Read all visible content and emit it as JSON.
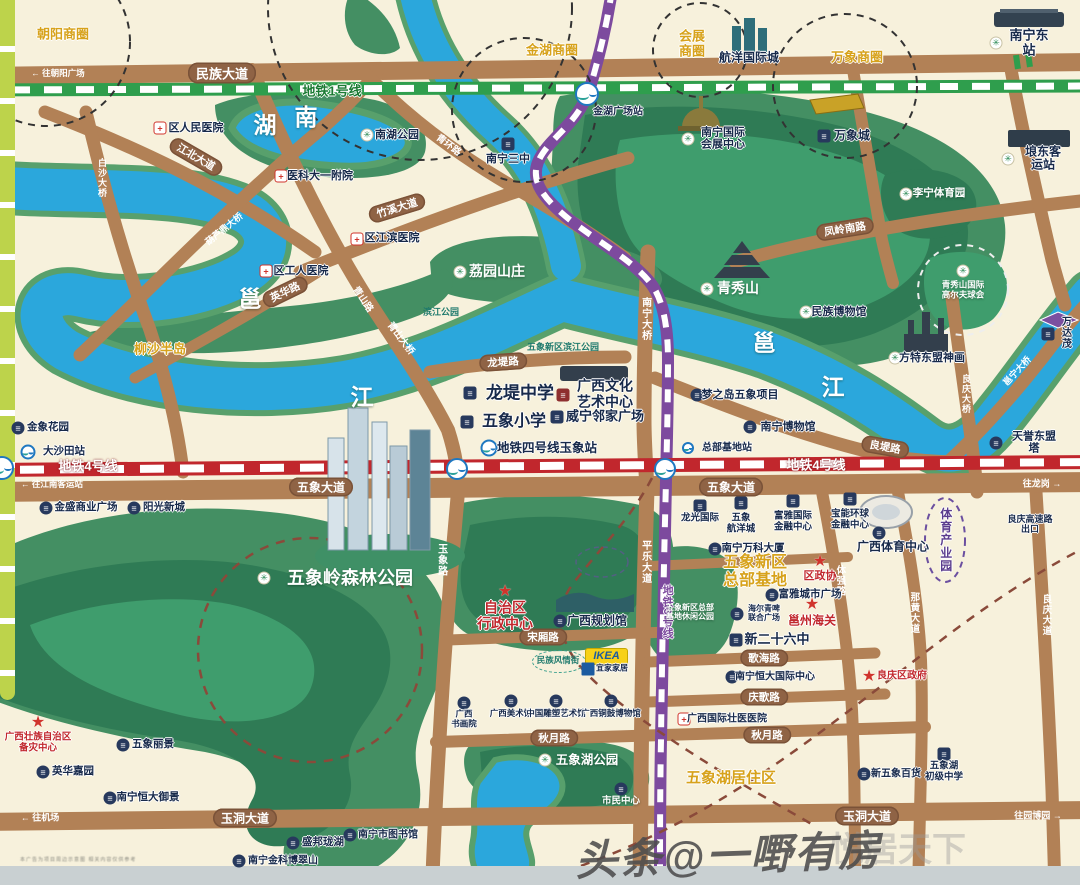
{
  "watermark": {
    "main": "头条@一嘢有房",
    "behind": "悦居天下"
  },
  "disclaimer": "本广告为项目周边示意图 相关内容仅供参考",
  "ikea_logo": "IKEA",
  "colors": {
    "water": "#2ba7dc",
    "park": "#448f63",
    "road": "#b28156",
    "metro1": "#2f9e4d",
    "metro3": "#7d4a9e",
    "metro4": "#c1272d",
    "gold": "#d7a21b",
    "lime": "#bdd34b"
  },
  "water_chars": [
    {
      "t": "湖",
      "x": 265,
      "y": 126
    },
    {
      "t": "南",
      "x": 306,
      "y": 118
    },
    {
      "t": "邕",
      "x": 250,
      "y": 300
    },
    {
      "t": "江",
      "x": 362,
      "y": 398
    },
    {
      "t": "邕",
      "x": 764,
      "y": 344
    },
    {
      "t": "江",
      "x": 833,
      "y": 388
    }
  ],
  "gold_labels": [
    {
      "t": "朝阳商圈",
      "x": 63,
      "y": 35,
      "fs": 13
    },
    {
      "t": "金湖商圈",
      "x": 552,
      "y": 51,
      "fs": 13
    },
    {
      "t": "会展\n商圈",
      "x": 692,
      "y": 44,
      "fs": 13
    },
    {
      "t": "万象商圈",
      "x": 857,
      "y": 58,
      "fs": 13
    },
    {
      "t": "柳沙半岛",
      "x": 160,
      "y": 350,
      "fs": 13
    },
    {
      "t": "五象新区\n总部基地",
      "x": 755,
      "y": 572,
      "fs": 16
    },
    {
      "t": "五象湖居住区",
      "x": 731,
      "y": 779,
      "fs": 15
    },
    {
      "t": "体育产业园",
      "x": 945,
      "y": 540,
      "fs": 12,
      "v": 1,
      "cl": "purple"
    }
  ],
  "road_pills": [
    {
      "t": "民族大道",
      "x": 222,
      "y": 73,
      "fs": 13
    },
    {
      "t": "江北大道",
      "x": 196,
      "y": 157,
      "r": 30
    },
    {
      "t": "竹溪大道",
      "x": 397,
      "y": 208,
      "r": -17
    },
    {
      "t": "英华路",
      "x": 285,
      "y": 292,
      "r": -26
    },
    {
      "t": "龙堤路",
      "x": 503,
      "y": 362,
      "r": -4
    },
    {
      "t": "良堤路",
      "x": 885,
      "y": 447,
      "r": 10
    },
    {
      "t": "凤岭南路",
      "x": 845,
      "y": 229,
      "r": -9
    },
    {
      "t": "五象大道",
      "x": 321,
      "y": 487,
      "fs": 12
    },
    {
      "t": "五象大道",
      "x": 731,
      "y": 487,
      "fs": 12
    },
    {
      "t": "玉洞大道",
      "x": 245,
      "y": 818,
      "fs": 12
    },
    {
      "t": "玉洞大道",
      "x": 867,
      "y": 816,
      "fs": 12
    },
    {
      "t": "宋厢路",
      "x": 543,
      "y": 637
    },
    {
      "t": "秋月路",
      "x": 554,
      "y": 738
    },
    {
      "t": "秋月路",
      "x": 767,
      "y": 735
    },
    {
      "t": "歌海路",
      "x": 764,
      "y": 658
    },
    {
      "t": "庆歌路",
      "x": 764,
      "y": 697
    }
  ],
  "road_names": [
    {
      "t": "白沙大桥",
      "x": 102,
      "y": 178,
      "v": 1,
      "fs": 9
    },
    {
      "t": "葫芦鼎大桥",
      "x": 224,
      "y": 229,
      "r": -39,
      "fs": 9
    },
    {
      "t": "青山路",
      "x": 362,
      "y": 300,
      "r": 56,
      "fs": 9.5
    },
    {
      "t": "青山大桥",
      "x": 400,
      "y": 339,
      "r": 53,
      "fs": 9.5
    },
    {
      "t": "青环路",
      "x": 448,
      "y": 146,
      "r": 37,
      "fs": 9.5
    },
    {
      "t": "南宁大桥",
      "x": 645,
      "y": 319,
      "v": 1,
      "fs": 10
    },
    {
      "t": "平乐大道",
      "x": 645,
      "y": 562,
      "v": 1,
      "fs": 10
    },
    {
      "t": "玉象路",
      "x": 441,
      "y": 560,
      "v": 1,
      "fs": 10
    },
    {
      "t": "良庆大桥",
      "x": 966,
      "y": 394,
      "v": 1,
      "fs": 9
    },
    {
      "t": "邕宁大桥",
      "x": 1017,
      "y": 371,
      "r": -47,
      "fs": 9
    },
    {
      "t": "体强路",
      "x": 839,
      "y": 581,
      "v": 1,
      "fs": 9.5
    },
    {
      "t": "那黄大道",
      "x": 913,
      "y": 613,
      "v": 1,
      "fs": 9.5
    },
    {
      "t": "良庆大道",
      "x": 1045,
      "y": 615,
      "v": 1,
      "fs": 9.5
    }
  ],
  "metro_labels": [
    {
      "t": "地铁1号线",
      "x": 332,
      "y": 92,
      "cl": "m1",
      "fs": 13
    },
    {
      "t": "地铁4号线",
      "x": 88,
      "y": 467,
      "cl": "m4",
      "fs": 13
    },
    {
      "t": "地铁4号线",
      "x": 816,
      "y": 466,
      "cl": "m4",
      "fs": 13
    },
    {
      "t": "地铁3号线",
      "x": 667,
      "y": 612,
      "cl": "m3",
      "v": 1,
      "fs": 11
    }
  ],
  "arrows": [
    {
      "t": "← 往朝阳广场",
      "x": 58,
      "y": 73,
      "fs": 8.5
    },
    {
      "t": "← 往江南客运站",
      "x": 52,
      "y": 484,
      "fs": 8.5
    },
    {
      "t": "← 往机场",
      "x": 40,
      "y": 817,
      "fs": 9
    },
    {
      "t": "往龙岗 →",
      "x": 1042,
      "y": 483,
      "fs": 9
    },
    {
      "t": "往园博园 →",
      "x": 1038,
      "y": 815,
      "fs": 9
    }
  ],
  "stations": [
    {
      "x": 587,
      "y": 94,
      "s": 24
    },
    {
      "x": 457,
      "y": 469,
      "s": 22
    },
    {
      "x": 665,
      "y": 469,
      "s": 22
    },
    {
      "x": 2,
      "y": 468,
      "s": 24
    },
    {
      "x": 28,
      "y": 452,
      "s": 15
    },
    {
      "x": 489,
      "y": 448,
      "s": 17
    },
    {
      "x": 688,
      "y": 448,
      "s": 12
    }
  ],
  "pois": [
    {
      "ic": "h",
      "ix": 160,
      "iy": 128,
      "t": "区人民医院",
      "tx": 196,
      "ty": 128,
      "fs": 11
    },
    {
      "ic": "h",
      "ix": 281,
      "iy": 176,
      "t": "医科大一附院",
      "tx": 320,
      "ty": 176,
      "fs": 11
    },
    {
      "ic": "h",
      "ix": 357,
      "iy": 239,
      "t": "区江滨医院",
      "tx": 392,
      "ty": 238,
      "fs": 11
    },
    {
      "ic": "h",
      "ix": 266,
      "iy": 271,
      "t": "区工人医院",
      "tx": 301,
      "ty": 271,
      "fs": 11
    },
    {
      "ic": "p",
      "ix": 367,
      "iy": 135,
      "t": "南湖公园",
      "tx": 397,
      "ty": 135,
      "fs": 11
    },
    {
      "ic": "b",
      "ix": 508,
      "iy": 144,
      "t": "南宁三中",
      "tx": 508,
      "ty": 159,
      "fs": 11
    },
    {
      "t": "金湖广场站",
      "tx": 618,
      "ty": 112,
      "fs": 10
    },
    {
      "t": "航洋国际城",
      "tx": 749,
      "ty": 58,
      "fs": 12
    },
    {
      "ic": "p",
      "ix": 688,
      "iy": 139,
      "t": "南宁国际\n会展中心",
      "tx": 723,
      "ty": 139,
      "fs": 11
    },
    {
      "ic": "b",
      "ix": 824,
      "iy": 136,
      "t": "万象城",
      "tx": 852,
      "ty": 136,
      "fs": 12
    },
    {
      "ic": "p",
      "ix": 996,
      "iy": 43,
      "t": "南宁东站",
      "tx": 1029,
      "ty": 43,
      "fs": 13
    },
    {
      "ic": "p",
      "ix": 1008,
      "iy": 159,
      "t": "埌东客运站",
      "tx": 1043,
      "ty": 159,
      "fs": 12
    },
    {
      "ic": "p",
      "ix": 906,
      "iy": 194,
      "t": "李宁体育园",
      "tx": 939,
      "ty": 194,
      "fs": 10.5,
      "cl": "white"
    },
    {
      "ic": "p",
      "ix": 806,
      "iy": 312,
      "t": "民族博物馆",
      "tx": 839,
      "ty": 312,
      "fs": 11
    },
    {
      "ic": "p",
      "ix": 895,
      "iy": 358,
      "t": "方特东盟神画",
      "tx": 932,
      "ty": 358,
      "fs": 11
    },
    {
      "ic": "b",
      "ix": 1048,
      "iy": 334,
      "t": "万达茂",
      "tx": 1067,
      "ty": 334,
      "fs": 10
    },
    {
      "ic": "d",
      "ix": 697,
      "iy": 395,
      "t": "梦之岛五象项目",
      "tx": 740,
      "ty": 395,
      "fs": 11
    },
    {
      "ic": "d",
      "ix": 750,
      "iy": 427,
      "t": "南宁博物馆",
      "tx": 788,
      "ty": 427,
      "fs": 11
    },
    {
      "ic": "d",
      "ix": 996,
      "iy": 443,
      "t": "天誉东盟塔",
      "tx": 1034,
      "ty": 443,
      "fs": 11
    },
    {
      "ic": "b",
      "ix": 470,
      "iy": 393,
      "t": "龙堤中学",
      "tx": 520,
      "ty": 393,
      "fs": 17
    },
    {
      "ic": "b",
      "ix": 467,
      "iy": 422,
      "t": "五象小学",
      "tx": 514,
      "ty": 422,
      "fs": 16
    },
    {
      "ic": "rb",
      "ix": 563,
      "iy": 395,
      "t": "广西文化\n艺术中心",
      "tx": 605,
      "ty": 394,
      "fs": 14
    },
    {
      "ic": "b",
      "ix": 557,
      "iy": 417,
      "t": "威宁邻家广场",
      "tx": 605,
      "ty": 417,
      "fs": 13
    },
    {
      "t": "地铁四号线玉象站",
      "tx": 547,
      "ty": 448,
      "fs": 12.5
    },
    {
      "t": "总部基地站",
      "tx": 727,
      "ty": 448,
      "fs": 10
    },
    {
      "ic": "d",
      "ix": 18,
      "iy": 428,
      "t": "金象花园",
      "tx": 48,
      "ty": 428,
      "fs": 10.5
    },
    {
      "t": "大沙田站",
      "tx": 64,
      "ty": 452,
      "fs": 10.5
    },
    {
      "ic": "d",
      "ix": 46,
      "iy": 508,
      "t": "金盛商业广场",
      "tx": 86,
      "ty": 508,
      "fs": 10.5
    },
    {
      "ic": "d",
      "ix": 134,
      "iy": 508,
      "t": "阳光新城",
      "tx": 164,
      "ty": 508,
      "fs": 10.5
    },
    {
      "ic": "b",
      "ix": 700,
      "iy": 506,
      "t": "龙光国际",
      "tx": 700,
      "ty": 519,
      "fs": 9.5
    },
    {
      "ic": "b",
      "ix": 741,
      "iy": 503,
      "t": "五象\n航洋城",
      "tx": 741,
      "ty": 524,
      "fs": 9.5
    },
    {
      "ic": "b",
      "ix": 793,
      "iy": 501,
      "t": "富雅国际\n金融中心",
      "tx": 793,
      "ty": 522,
      "fs": 9.5
    },
    {
      "ic": "b",
      "ix": 850,
      "iy": 499,
      "t": "宝能环球\n金融中心",
      "tx": 850,
      "ty": 520,
      "fs": 9.5
    },
    {
      "ic": "d",
      "ix": 879,
      "iy": 533,
      "t": "广西体育中心",
      "tx": 893,
      "ty": 547,
      "fs": 12
    },
    {
      "ic": "d",
      "ix": 715,
      "iy": 549,
      "t": "南宁万科大厦",
      "tx": 753,
      "ty": 549,
      "fs": 10.5
    },
    {
      "ic": "s",
      "ix": 820,
      "iy": 561,
      "t": "区政协",
      "tx": 820,
      "ty": 576,
      "fs": 11,
      "cl": "red"
    },
    {
      "ic": "d",
      "ix": 772,
      "iy": 595,
      "t": "富雅城市广场",
      "tx": 810,
      "ty": 595,
      "fs": 10.5
    },
    {
      "ic": "d",
      "ix": 737,
      "iy": 614,
      "t": "海尔青啤\n联合广场",
      "tx": 764,
      "ty": 614,
      "fs": 8
    },
    {
      "ic": "s",
      "ix": 812,
      "iy": 604,
      "t": "邕州海关",
      "tx": 812,
      "ty": 621,
      "fs": 12,
      "cl": "red"
    },
    {
      "ic": "s",
      "ix": 505,
      "iy": 591,
      "t": "自治区\n行政中心",
      "tx": 505,
      "ty": 616,
      "fs": 14,
      "cl": "red"
    },
    {
      "ic": "d",
      "ix": 560,
      "iy": 621,
      "t": "广西规划馆",
      "tx": 597,
      "ty": 621,
      "fs": 12
    },
    {
      "ic": "b",
      "ix": 736,
      "iy": 640,
      "t": "新二十六中",
      "tx": 777,
      "ty": 640,
      "fs": 13
    },
    {
      "ic": "d",
      "ix": 464,
      "iy": 703,
      "t": "广西\n书画院",
      "tx": 464,
      "ty": 719,
      "fs": 8.5
    },
    {
      "ic": "d",
      "ix": 511,
      "iy": 701,
      "t": "广西美术馆",
      "tx": 511,
      "ty": 714,
      "fs": 8.5
    },
    {
      "ic": "d",
      "ix": 556,
      "iy": 701,
      "t": "中国雕塑艺术馆",
      "tx": 556,
      "ty": 714,
      "fs": 8.5
    },
    {
      "ic": "d",
      "ix": 611,
      "iy": 701,
      "t": "广西铜鼓博物馆",
      "tx": 611,
      "ty": 714,
      "fs": 8.5
    },
    {
      "ic": "h",
      "ix": 684,
      "iy": 719,
      "t": "广西国际壮医医院",
      "tx": 727,
      "ty": 719,
      "fs": 10
    },
    {
      "ic": "d",
      "ix": 732,
      "iy": 677,
      "t": "南宁恒大国际中心",
      "tx": 775,
      "ty": 677,
      "fs": 10
    },
    {
      "ic": "s",
      "ix": 869,
      "iy": 676,
      "t": "良庆区政府",
      "tx": 902,
      "ty": 676,
      "fs": 10,
      "cl": "red"
    },
    {
      "ic": "d",
      "ix": 864,
      "iy": 774,
      "t": "新五象百货",
      "tx": 896,
      "ty": 774,
      "fs": 10
    },
    {
      "ic": "b",
      "ix": 944,
      "iy": 754,
      "t": "五象湖\n初级中学",
      "tx": 944,
      "ty": 772,
      "fs": 9.5
    },
    {
      "ic": "d",
      "ix": 621,
      "iy": 789,
      "t": "市民中心",
      "tx": 621,
      "ty": 802,
      "fs": 9.5,
      "cl": "white"
    },
    {
      "ic": "s",
      "ix": 38,
      "iy": 722,
      "t": "广西壮族自治区\n备灾中心",
      "tx": 38,
      "ty": 743,
      "fs": 9.5,
      "cl": "red"
    },
    {
      "ic": "d",
      "ix": 123,
      "iy": 745,
      "t": "五象丽景",
      "tx": 153,
      "ty": 745,
      "fs": 10.5
    },
    {
      "ic": "d",
      "ix": 43,
      "iy": 772,
      "t": "英华嘉园",
      "tx": 73,
      "ty": 772,
      "fs": 10.5
    },
    {
      "ic": "d",
      "ix": 110,
      "iy": 798,
      "t": "南宁恒大御景",
      "tx": 148,
      "ty": 798,
      "fs": 10.5
    },
    {
      "ic": "d",
      "ix": 293,
      "iy": 843,
      "t": "盛邦珑湖",
      "tx": 323,
      "ty": 843,
      "fs": 10.5
    },
    {
      "ic": "d",
      "ix": 350,
      "iy": 835,
      "t": "南宁市图书馆",
      "tx": 388,
      "ty": 835,
      "fs": 10
    },
    {
      "ic": "d",
      "ix": 239,
      "iy": 861,
      "t": "南宁金科博翠山",
      "tx": 283,
      "ty": 861,
      "fs": 10
    },
    {
      "ic": "p",
      "ix": 963,
      "iy": 271,
      "t": "青秀山国际\n高尔夫球会",
      "tx": 963,
      "ty": 290,
      "fs": 8.5,
      "cl": "white"
    },
    {
      "ic": "p",
      "ix": 460,
      "iy": 272,
      "t": "荔园山庄",
      "tx": 497,
      "ty": 272,
      "fs": 14,
      "cl": "white"
    },
    {
      "ic": "p",
      "ix": 707,
      "iy": 289,
      "t": "青秀山",
      "tx": 738,
      "ty": 289,
      "fs": 14,
      "cl": "white"
    },
    {
      "ic": "p",
      "ix": 264,
      "iy": 578,
      "t": "五象岭森林公园",
      "tx": 350,
      "ty": 578,
      "fs": 18,
      "cl": "white"
    },
    {
      "ic": "p",
      "ix": 545,
      "iy": 760,
      "t": "五象湖公园",
      "tx": 587,
      "ty": 760,
      "fs": 12.5,
      "cl": "white"
    },
    {
      "t": "五象新区总部\n基地休闲公园",
      "tx": 690,
      "ty": 613,
      "fs": 8,
      "cl": "white"
    },
    {
      "t": "滨江公园",
      "tx": 441,
      "ty": 312,
      "fs": 9,
      "cl": "teal"
    },
    {
      "t": "五象新区滨江公园",
      "tx": 563,
      "ty": 347,
      "fs": 9,
      "cl": "teal"
    },
    {
      "t": "良庆高速路出口",
      "tx": 1030,
      "ty": 524,
      "fs": 9
    },
    {
      "t": "民族风情街",
      "tx": 558,
      "ty": 661,
      "fs": 8.5,
      "cl": "teal"
    },
    {
      "ic": "ik",
      "ix": 588,
      "iy": 669,
      "t": "宜家家居",
      "tx": 612,
      "ty": 669,
      "fs": 8
    }
  ]
}
